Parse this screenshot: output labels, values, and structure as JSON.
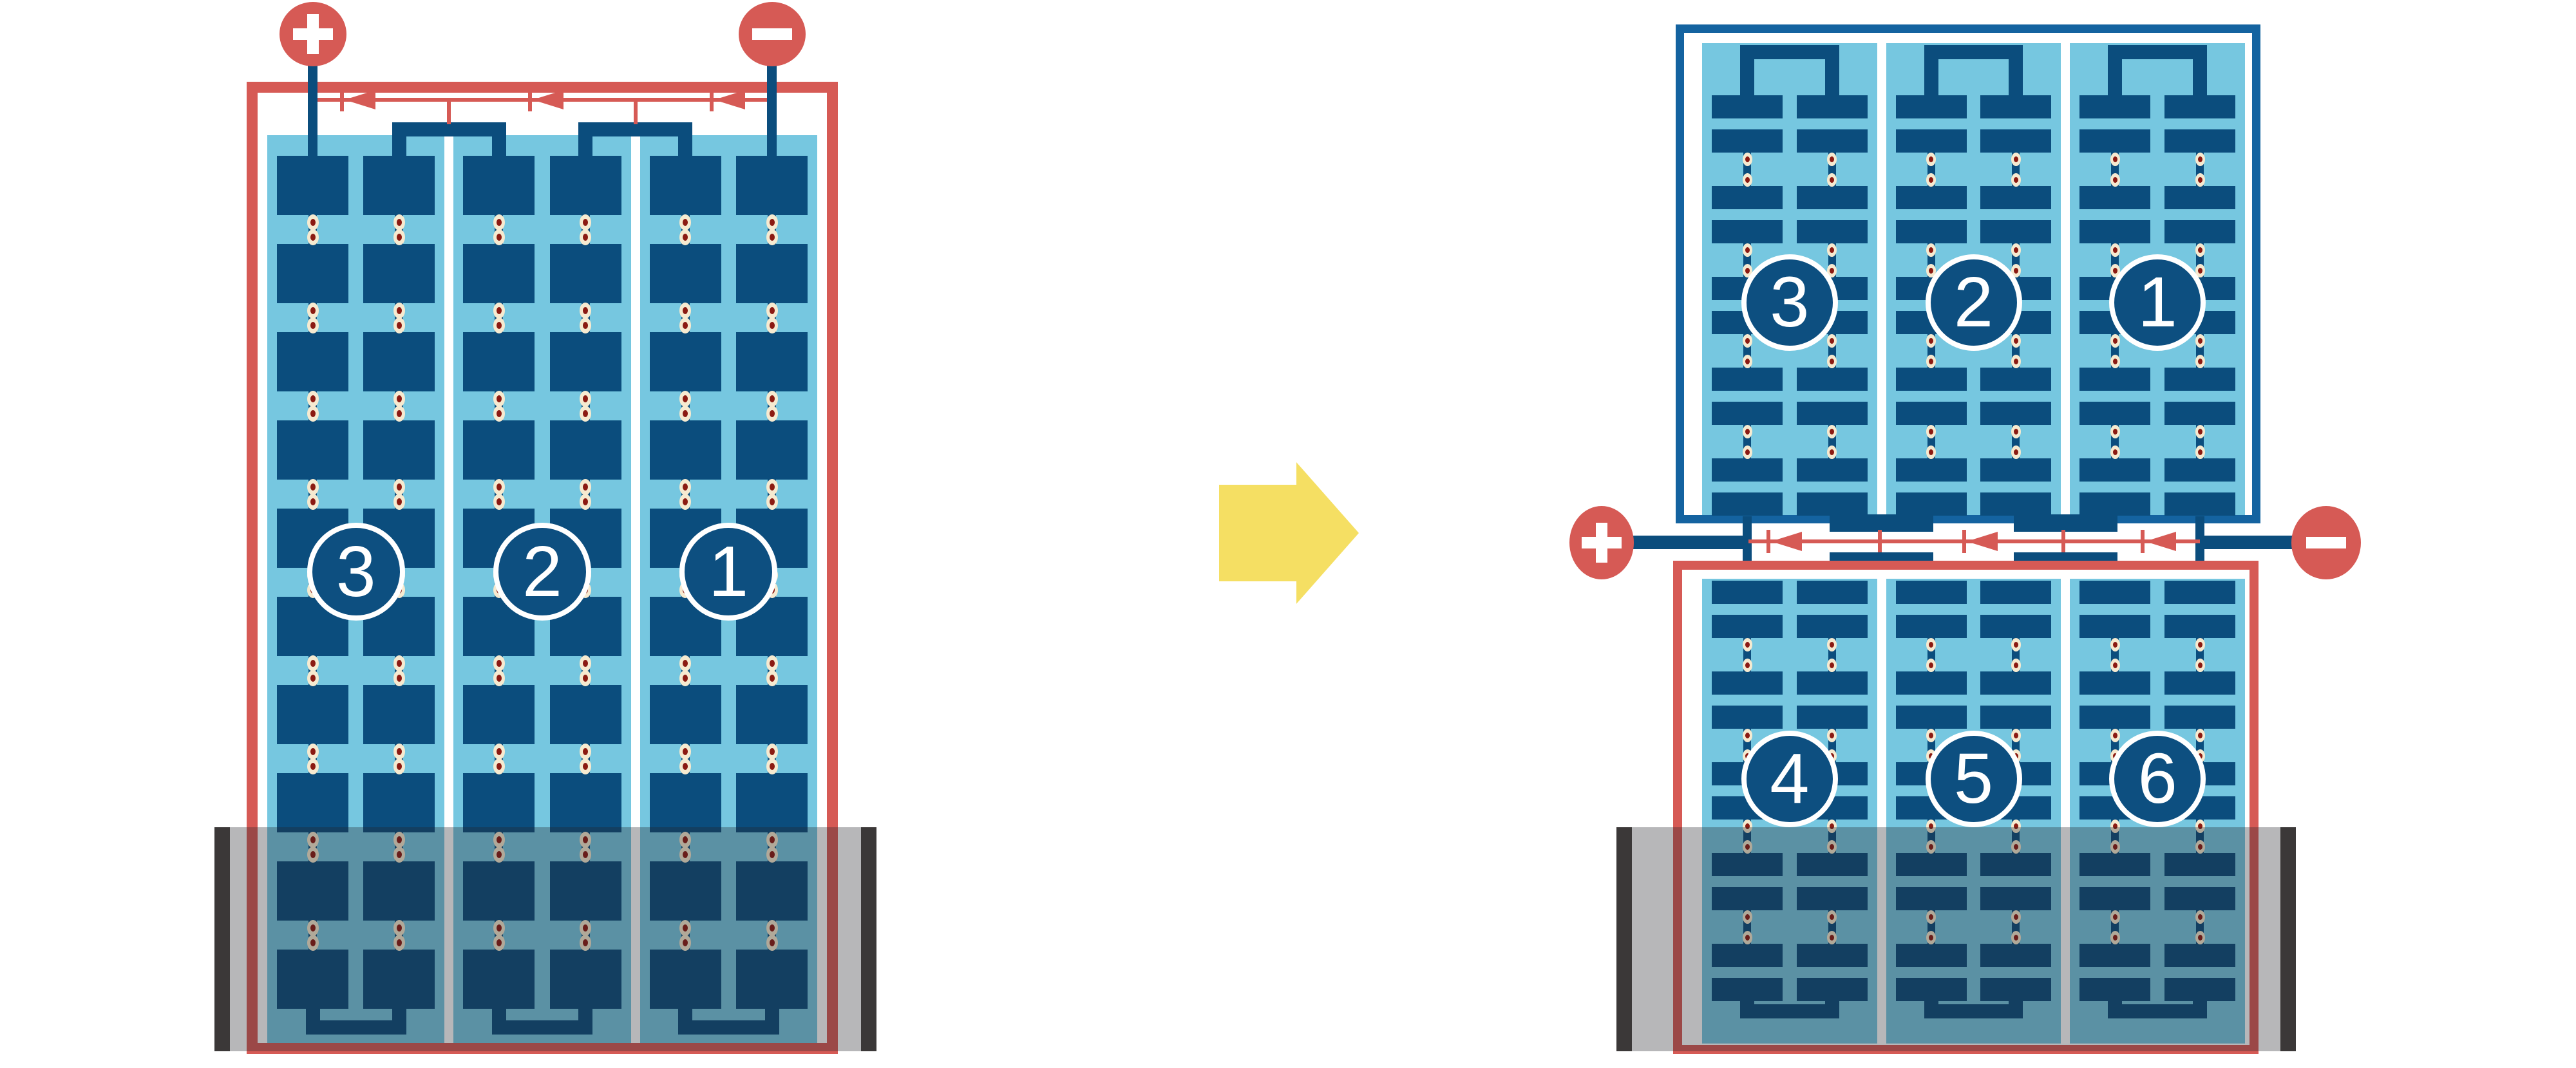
{
  "diagram_title": "PV module string wiring: portrait module vs two stacked landscape modules under partial shading",
  "colors": {
    "red": "#D65A55",
    "navy": "#0B4D7D",
    "frame_blue": "#1463A0",
    "light_blue": "#76C7E0",
    "solder_cream": "#F6EAD0",
    "solder_core": "#8B1A12",
    "shade_bar": "#3B3838",
    "shade_overlay": "rgba(35,36,41,0.33)",
    "arrow_yellow": "#F5DF63",
    "white": "#FFFFFF"
  },
  "left_module": {
    "orientation": "portrait",
    "frame_color_name": "red",
    "terminals": {
      "positive": "+",
      "negative": "−"
    },
    "strings": [
      {
        "label": "3"
      },
      {
        "label": "2"
      },
      {
        "label": "1"
      }
    ],
    "rows": 10,
    "diode_count": 3,
    "shaded_bottom": true
  },
  "transform_arrow": {
    "direction": "right"
  },
  "right_top_module": {
    "orientation": "landscape",
    "frame_color_name": "frame_blue",
    "strings": [
      {
        "label": "3"
      },
      {
        "label": "2"
      },
      {
        "label": "1"
      }
    ],
    "row_pairs": 5,
    "shaded_bottom": false
  },
  "junction": {
    "terminals": {
      "positive": "+",
      "negative": "−"
    },
    "diode_count": 3
  },
  "right_bottom_module": {
    "orientation": "landscape",
    "frame_color_name": "red",
    "strings": [
      {
        "label": "4"
      },
      {
        "label": "5"
      },
      {
        "label": "6"
      }
    ],
    "row_pairs": 5,
    "shaded_bottom": true
  }
}
